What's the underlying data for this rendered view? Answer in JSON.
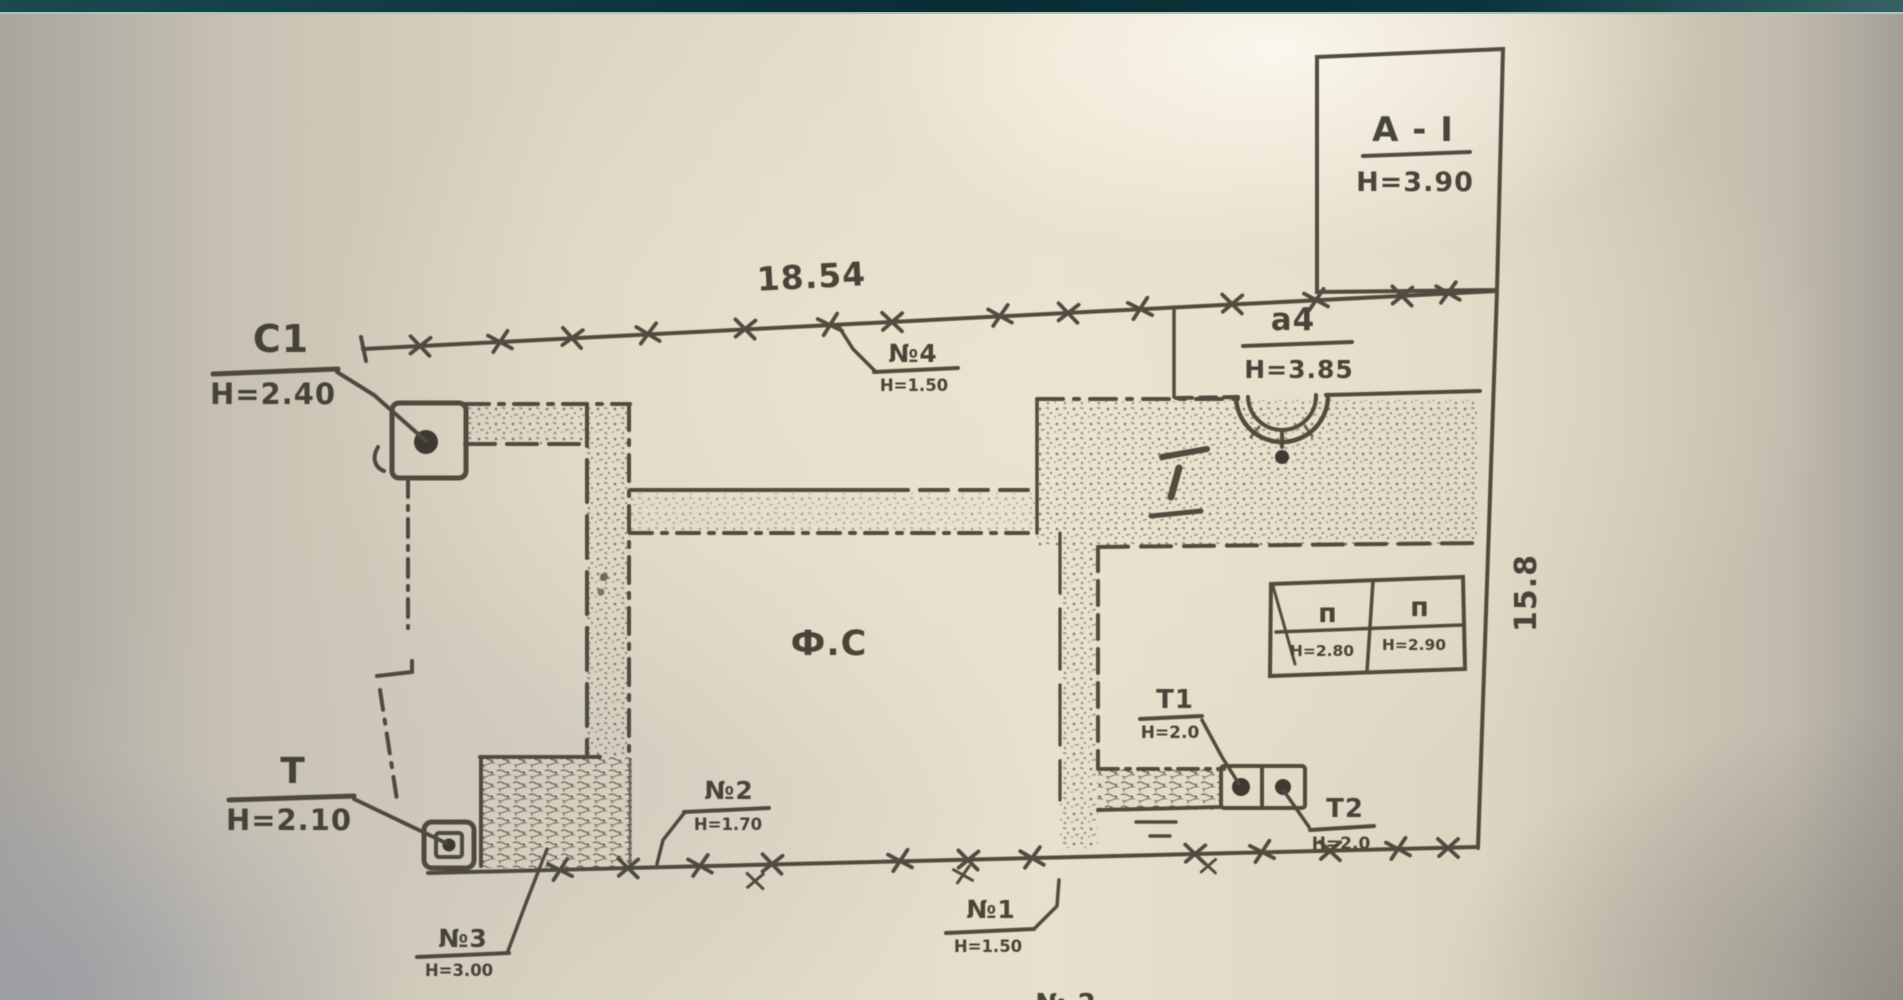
{
  "page": {
    "description": "Scanned hand-drawn cadastral site plan on aged paper",
    "top_bar_color": "#0b3237",
    "paper_color": "#e8e0cd",
    "ink_color": "#453f35"
  },
  "dimensions": {
    "top_length": "18.54",
    "right_length": "15.8"
  },
  "labels": {
    "block_a1": {
      "name": "A - I",
      "height": "H=3.90"
    },
    "block_a4": {
      "name": "a4",
      "height": "H=3.85"
    },
    "c1": {
      "name": "C1",
      "height": "H=2.40"
    },
    "t": {
      "name": "T",
      "height": "H=2.10"
    },
    "t1": {
      "name": "T1",
      "height": "H=2.0"
    },
    "t2": {
      "name": "T2",
      "height": "H=2.0"
    },
    "p_left": {
      "name": "п",
      "height": "H=2.80"
    },
    "p_right": {
      "name": "п",
      "height": "H=2.90"
    },
    "n1": {
      "name": "№1",
      "height": "H=1.50"
    },
    "n2": {
      "name": "№2",
      "height": "H=1.70"
    },
    "n3": {
      "name": "№3",
      "height": "H=3.00"
    },
    "n4": {
      "name": "№4",
      "height": "H=1.50"
    },
    "center_room": "Ф.С",
    "bottom_partial": "№ 2"
  }
}
